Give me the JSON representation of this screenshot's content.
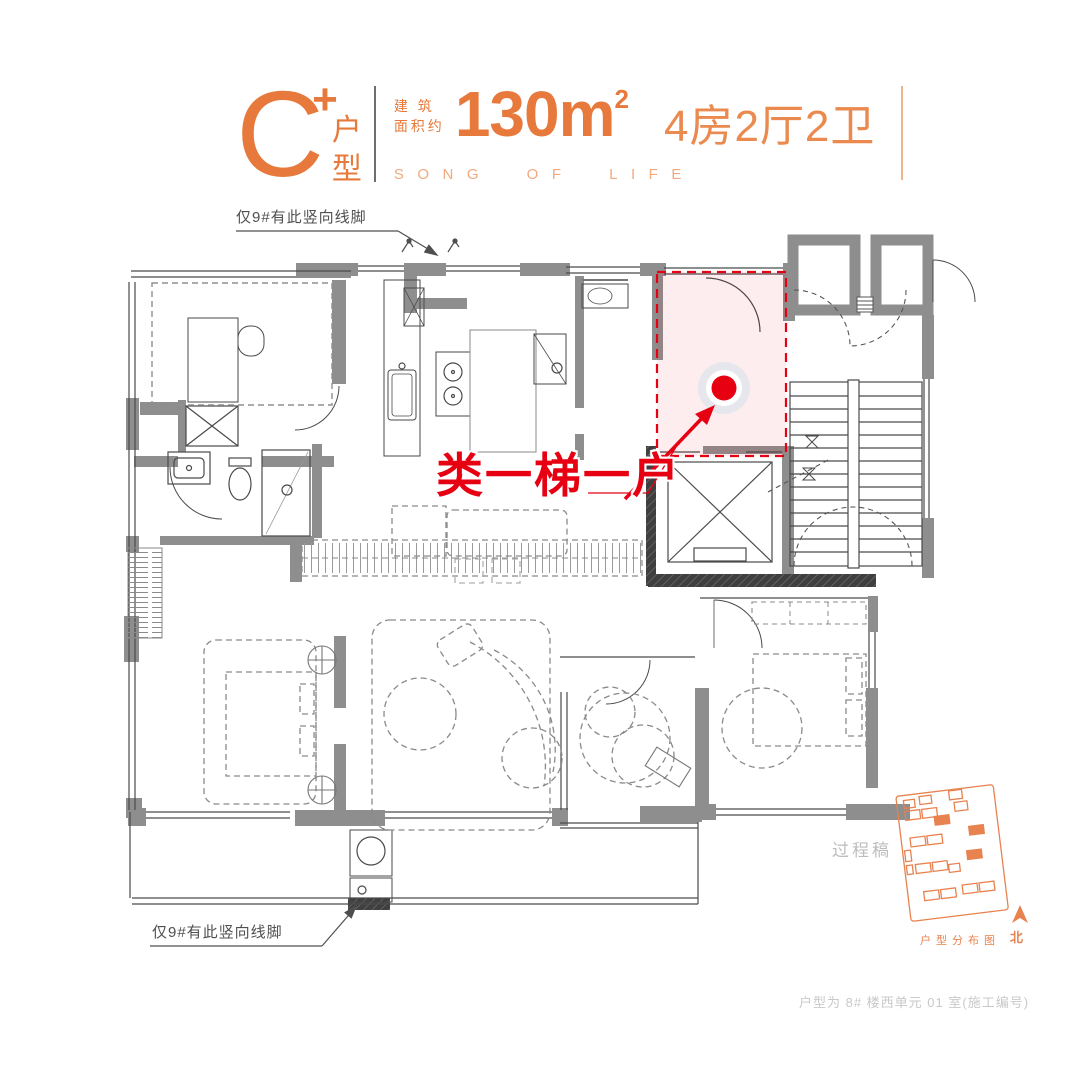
{
  "header": {
    "type_letter": "C",
    "type_plus": "+",
    "type_label_1": "户",
    "type_label_2": "型",
    "area_prefix_1": "建 筑",
    "area_prefix_2": "面积约",
    "area_value": "130m",
    "area_sup": "2",
    "rooms_text": "4房2厅2卫",
    "slogan": "SONG OF LIFE"
  },
  "plan": {
    "highlight_label": "类一梯一户",
    "top_note": "仅9#有此竖向线脚",
    "bottom_note": "仅9#有此竖向线脚",
    "draft_watermark": "过程稿"
  },
  "inset": {
    "caption": "户型分布图",
    "north_label": "北"
  },
  "footer": {
    "note": "户型为 8# 楼西单元 01 室(施工编号)"
  },
  "colors": {
    "brand_orange": "#E6793B",
    "accent_red": "#E60012",
    "wall_gray": "#8E8E8E",
    "site_orange": "#E8824E"
  }
}
